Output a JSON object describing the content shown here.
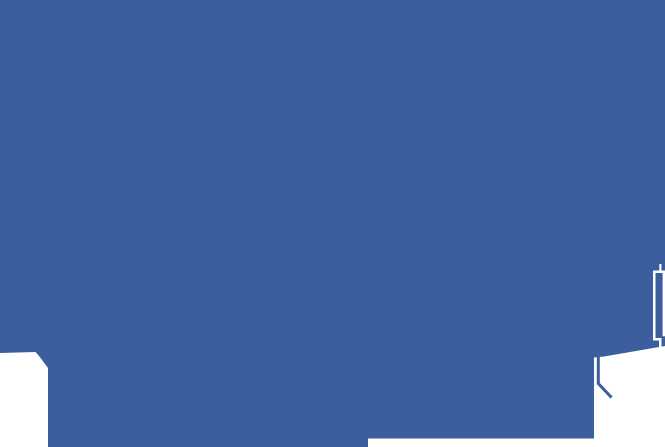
{
  "canvas": {
    "width": 665,
    "height": 447
  },
  "colors": {
    "blue": "#3b5e9e",
    "white": "#ffffff"
  },
  "shapes": {
    "blue_field": {
      "points": "0,0 665,0 665,346 604,356.5 594,357.5 594,438.5 368,438.5 368,447 48,447 48,368 36,352 0,353 0,0"
    },
    "corner_arc_stroke": {
      "d": "M36.5,351.5 L51,363.5"
    },
    "flag_stroke": {
      "d": "M598.3,356 L598.3,383.5 L611.5,397.5"
    },
    "window_outline": {
      "d": "M653,270.5 H665 V273 H655.5 V340.5 H653 Z M662.6,273 H665 V336.2 H662.6 Z M655.5,338 H661.5 V340.5 H655.5 Z M659,340.5 H661.5 V347.5 H659 Z M659.3,264 H661.4 V270.5 H659.3 Z"
    }
  }
}
